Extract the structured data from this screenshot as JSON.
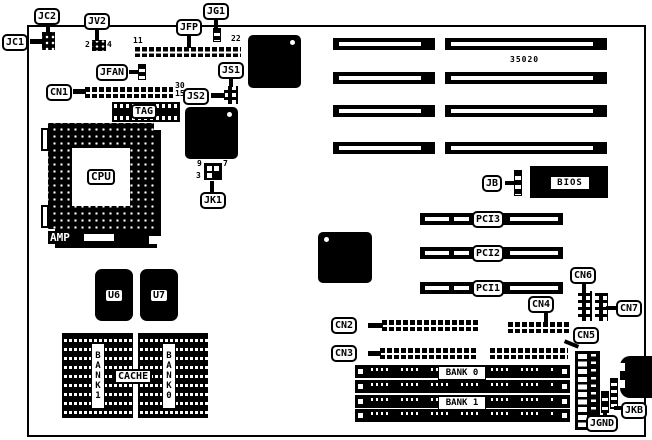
{
  "diagram": {
    "title": "motherboard layout diagram",
    "colors": {
      "foreground": "#000000",
      "background": "#ffffff"
    },
    "callouts": {
      "jc1": "JC1",
      "jc2": "JC2",
      "jv2": "JV2",
      "jg1": "JG1",
      "jfp": "JFP",
      "jfan": "JFAN",
      "cn1": "CN1",
      "js1": "JS1",
      "js2": "JS2",
      "jk1": "JK1",
      "jb": "JB",
      "cn2": "CN2",
      "cn3": "CN3",
      "cn4": "CN4",
      "cn5": "CN5",
      "cn6": "CN6",
      "cn7": "CN7",
      "jkb": "JKB",
      "jgnd": "JGND"
    },
    "chips": {
      "cpu": "CPU",
      "amp": "AMP",
      "tag": "TAG",
      "u6": "U6",
      "u7": "U7",
      "bios": "BIOS",
      "cache": "CACHE"
    },
    "slots": {
      "pci": [
        "PCI3",
        "PCI2",
        "PCI1"
      ],
      "isa_part_number": "35020"
    },
    "memory": {
      "simm_bank0": "BANK 0",
      "simm_bank1": "BANK 1",
      "cache_bank1": "BANK1",
      "cache_bank0": "BANK0"
    },
    "pin_numbers": {
      "jfp_first": "11",
      "jfp_last": "22",
      "jv2_pin2": "2",
      "jv2_pin4": "4",
      "cn1_pin30": "30",
      "cn1_pin15": "15",
      "jk1_pin9": "9",
      "jk1_pin7": "7",
      "jk1_pin3": "3"
    }
  }
}
